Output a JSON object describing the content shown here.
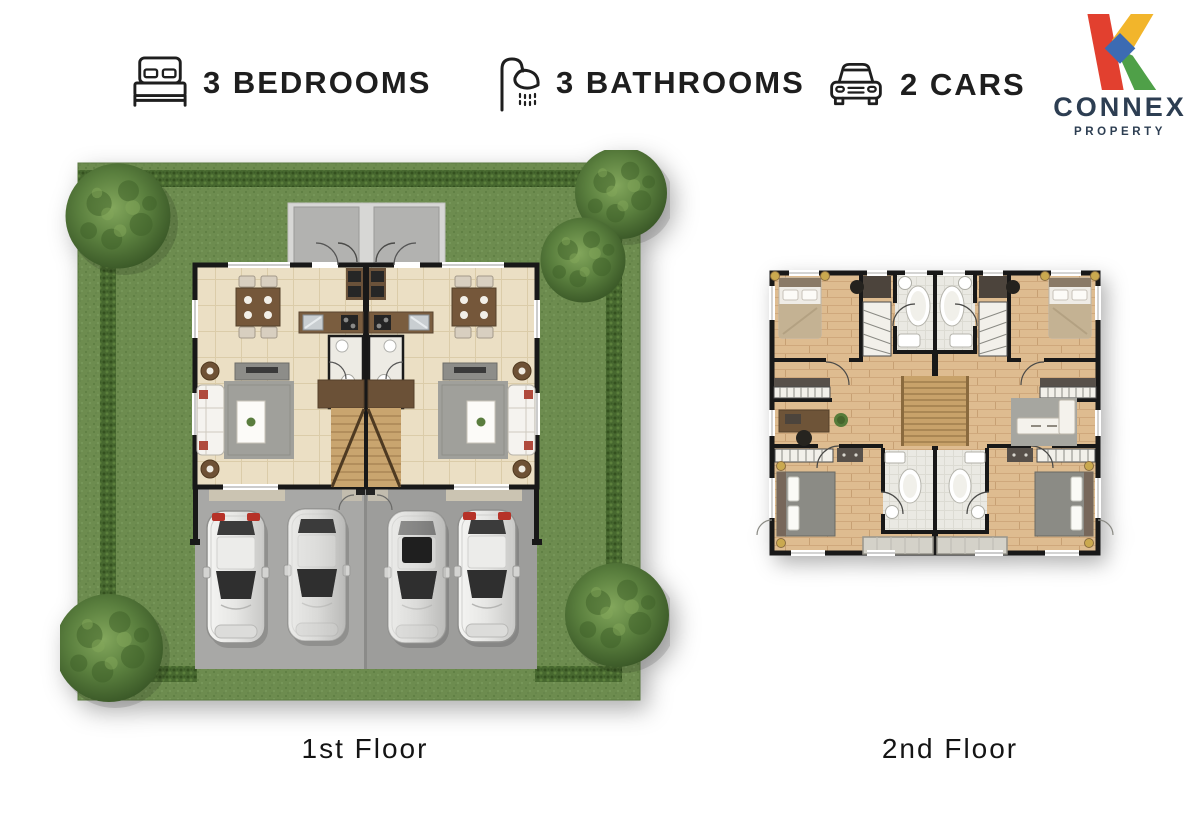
{
  "header": {
    "features": [
      {
        "icon": "bed-icon",
        "label": "3 BEDROOMS"
      },
      {
        "icon": "shower-icon",
        "label": "3 BATHROOMS"
      },
      {
        "icon": "car-icon",
        "label": "2 CARS"
      }
    ]
  },
  "logo": {
    "brand": "CONNEX",
    "subtitle": "PROPERTY",
    "colors": {
      "red": "#E2402F",
      "yellow": "#F2B52B",
      "green": "#4FA048",
      "blue": "#3C6BB3",
      "text": "#2D3E52"
    }
  },
  "floor_plans": [
    {
      "id": "first-floor",
      "label": "1st Floor",
      "description": "site plan: hedge-bordered garden, four corner trees, twin duplex ground floor, driveway with four parked cars"
    },
    {
      "id": "second-floor",
      "label": "2nd Floor",
      "description": "upper floor plan: mirrored twin units with bedrooms, two bathrooms each, central stairs and balconies"
    }
  ],
  "palette": {
    "grass": "#6D8C4F",
    "hedge": "#47682F",
    "tree": "#5A7F3E",
    "floor_tile": "#EBDFC4",
    "wood_floor": "#DEBC90",
    "wall": "#181818",
    "driveway": "#A8A8A6",
    "bath": "#EAE9E3"
  }
}
